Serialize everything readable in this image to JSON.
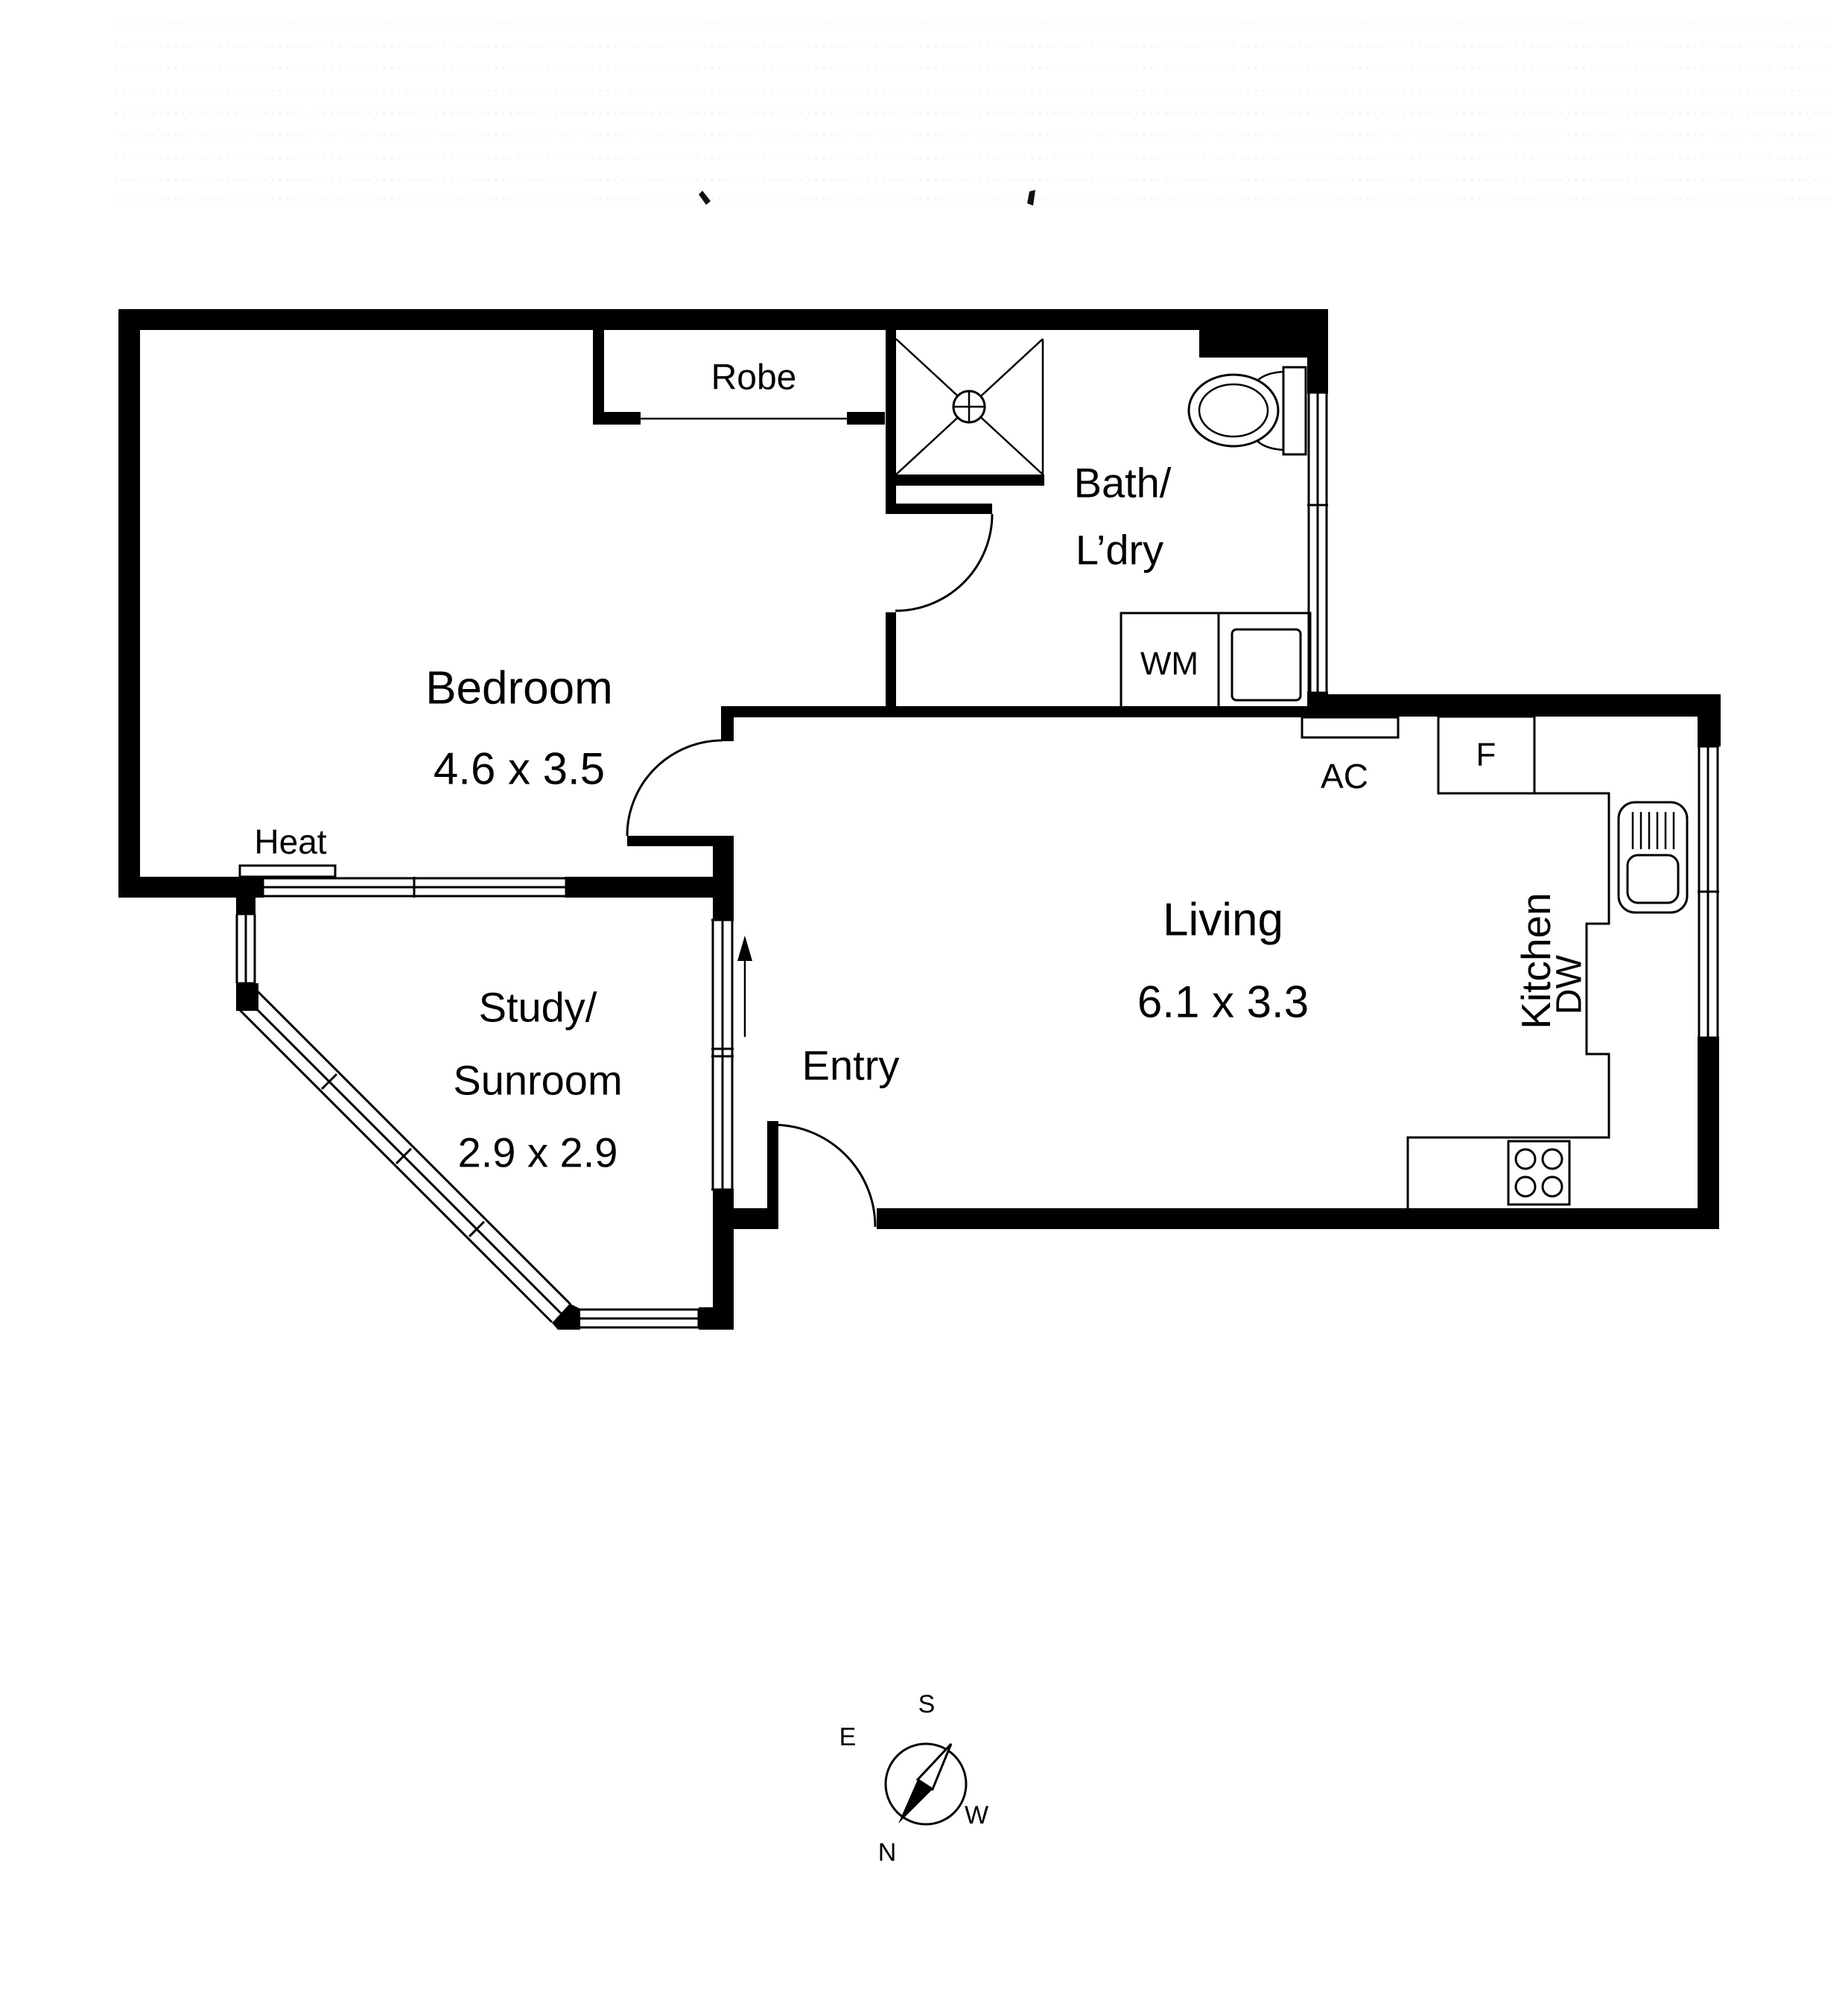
{
  "colors": {
    "wall": "#000000",
    "line": "#000000",
    "background": "#ffffff",
    "watermark_dots": "#edc9d2"
  },
  "rooms": {
    "bedroom": {
      "name": "Bedroom",
      "dims": "4.6 x 3.5"
    },
    "robe": {
      "name": "Robe"
    },
    "bath": {
      "line1": "Bath/",
      "line2": "L’dry"
    },
    "living": {
      "name": "Living",
      "dims": "6.1 x 3.3"
    },
    "entry": {
      "name": "Entry"
    },
    "kitchen": {
      "name": "Kitchen"
    },
    "study": {
      "line1": "Study/",
      "line2": "Sunroom",
      "dims": "2.9 x 2.9"
    }
  },
  "fixtures": {
    "washing_machine": "WM",
    "air_conditioner": "AC",
    "fridge": "F",
    "dishwasher": "DW",
    "heater": "Heat"
  },
  "compass": {
    "north": "N",
    "south": "S",
    "east": "E",
    "west": "W"
  }
}
